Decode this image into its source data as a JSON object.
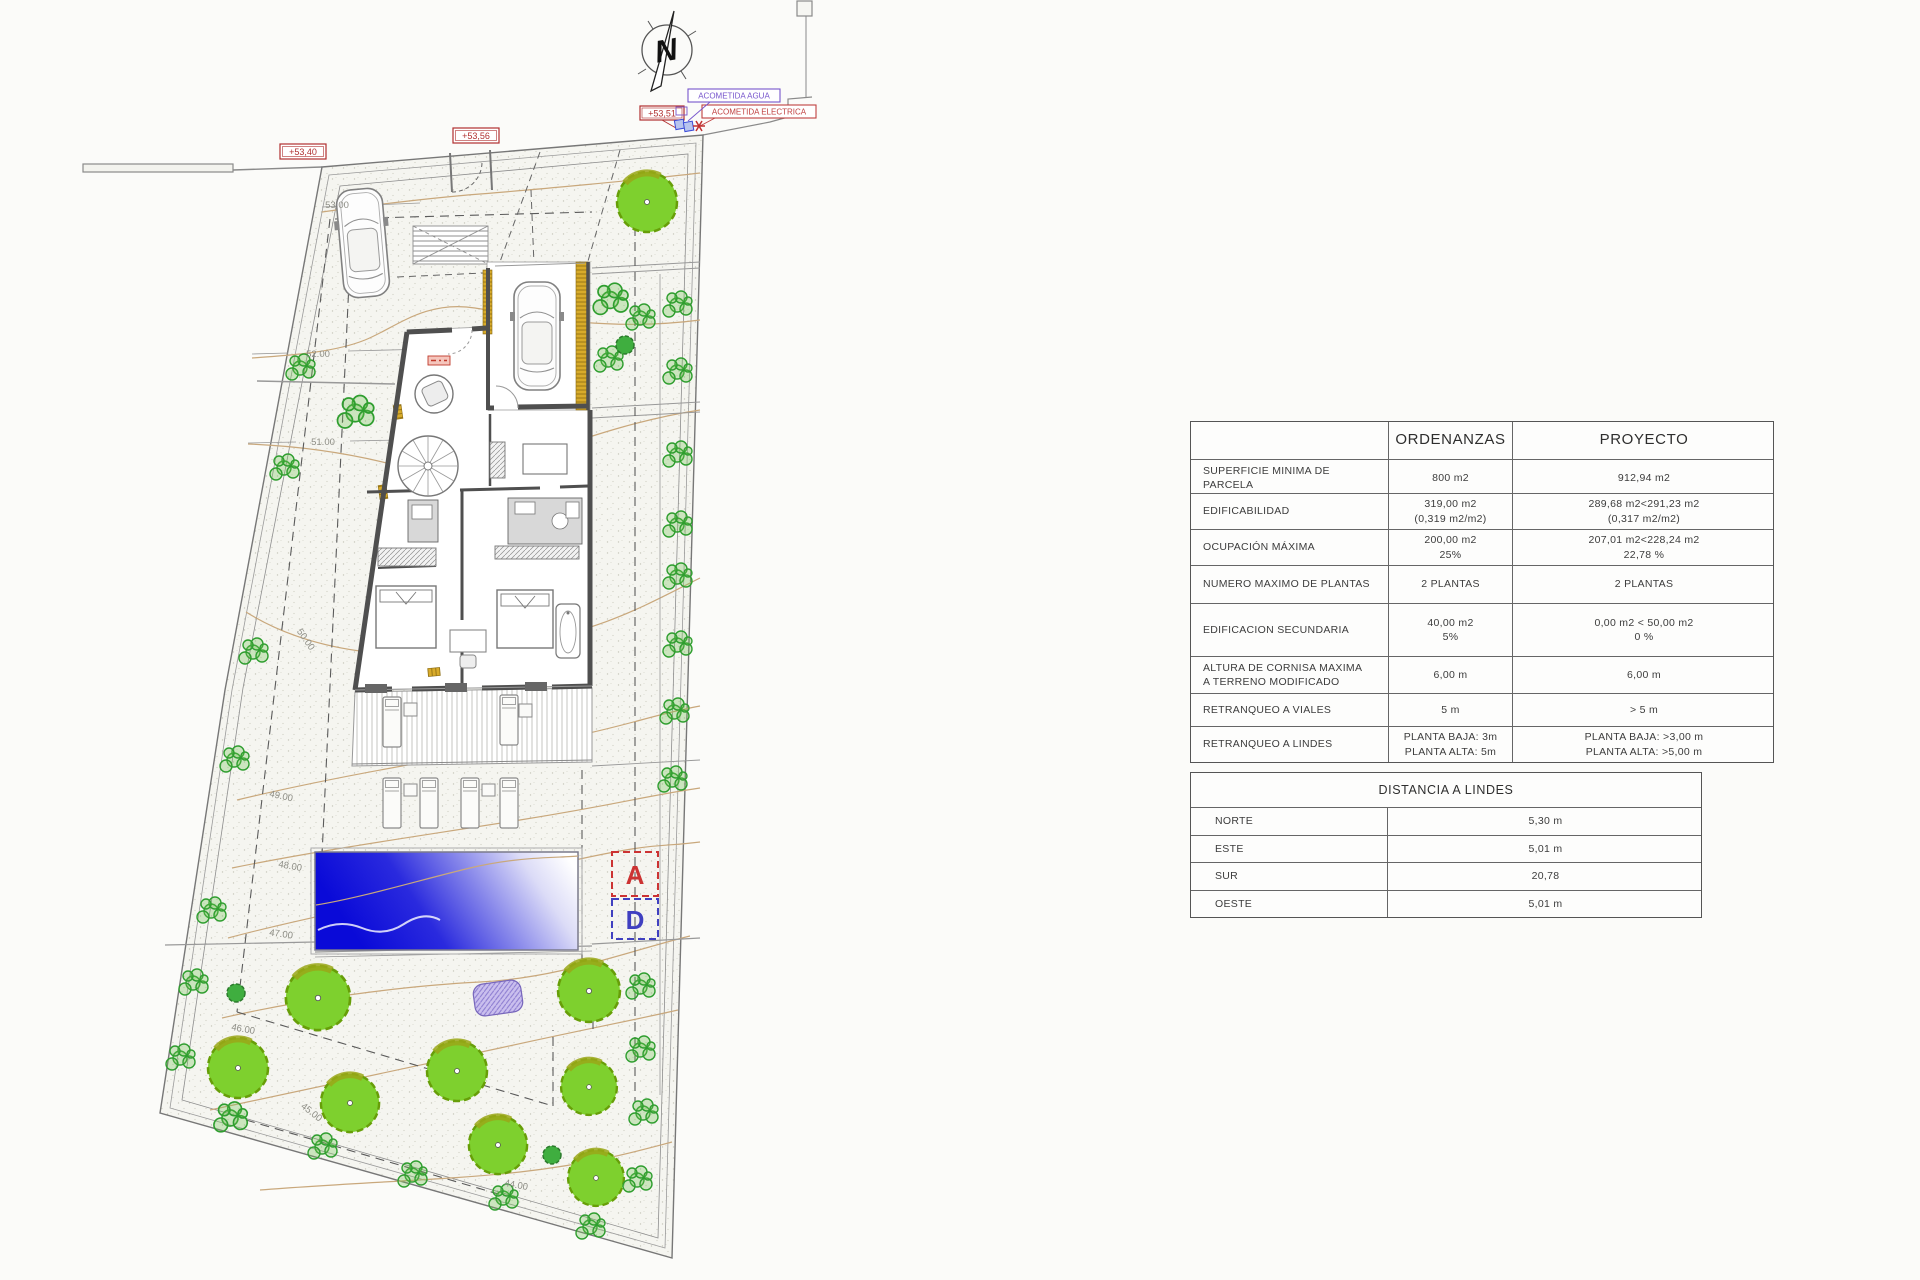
{
  "plan": {
    "markers": {
      "m1": "+53,40",
      "m2": "+53,56",
      "m3": "+53,51",
      "agua": "ACOMETIDA AGUA",
      "electrica": "ACOMETIDA ELECTRICA"
    },
    "sections": {
      "a": "A",
      "d": "D"
    },
    "compass": {
      "n": "N"
    },
    "contours": {
      "c53": "53.00",
      "c52": "52.00",
      "c51": "51.00",
      "c50": "50.00",
      "c49": "49.00",
      "c48": "48.00",
      "c47": "47.00",
      "c46": "46.00",
      "c45": "45.00",
      "c44": "44.00"
    },
    "colors": {
      "marker_red": "#b03030",
      "marker_purple": "#7755cc",
      "pool_blue": "#0a0ad8",
      "tree_green": "#7ed02e",
      "contour_tan": "#c9a87c"
    }
  },
  "tables": {
    "normativa": {
      "headers": {
        "blank": "",
        "ordenanzas": "ORDENANZAS",
        "proyecto": "PROYECTO"
      },
      "rows": [
        {
          "label": "SUPERFICIE MINIMA DE PARCELA",
          "ord": "800 m2",
          "proy": "912,94 m2"
        },
        {
          "label": "EDIFICABILIDAD",
          "ord": "319,00 m2\n(0,319 m2/m2)",
          "proy": "289,68 m2<291,23 m2\n(0,317 m2/m2)"
        },
        {
          "label": "OCUPACIÓN MÁXIMA",
          "ord": "200,00 m2\n25%",
          "proy": "207,01 m2<228,24 m2\n22,78 %"
        },
        {
          "label": "NUMERO MAXIMO DE PLANTAS",
          "ord": "2 PLANTAS",
          "proy": "2 PLANTAS"
        },
        {
          "label": "EDIFICACION SECUNDARIA",
          "ord": "40,00 m2\n5%",
          "proy": "0,00 m2 < 50,00 m2\n0 %"
        },
        {
          "label": "ALTURA DE CORNISA MAXIMA\nA TERRENO MODIFICADO",
          "ord": "6,00 m",
          "proy": "6,00 m"
        },
        {
          "label": "RETRANQUEO A VIALES",
          "ord": "5 m",
          "proy": "> 5 m"
        },
        {
          "label": "RETRANQUEO A LINDES",
          "ord": "PLANTA BAJA: 3m\nPLANTA ALTA: 5m",
          "proy": "PLANTA BAJA: >3,00 m\nPLANTA ALTA: >5,00 m"
        }
      ]
    },
    "lindes": {
      "title": "DISTANCIA A LINDES",
      "rows": [
        {
          "label": "NORTE",
          "value": "5,30 m"
        },
        {
          "label": "ESTE",
          "value": "5,01 m"
        },
        {
          "label": "SUR",
          "value": "20,78"
        },
        {
          "label": "OESTE",
          "value": "5,01 m"
        }
      ]
    }
  }
}
